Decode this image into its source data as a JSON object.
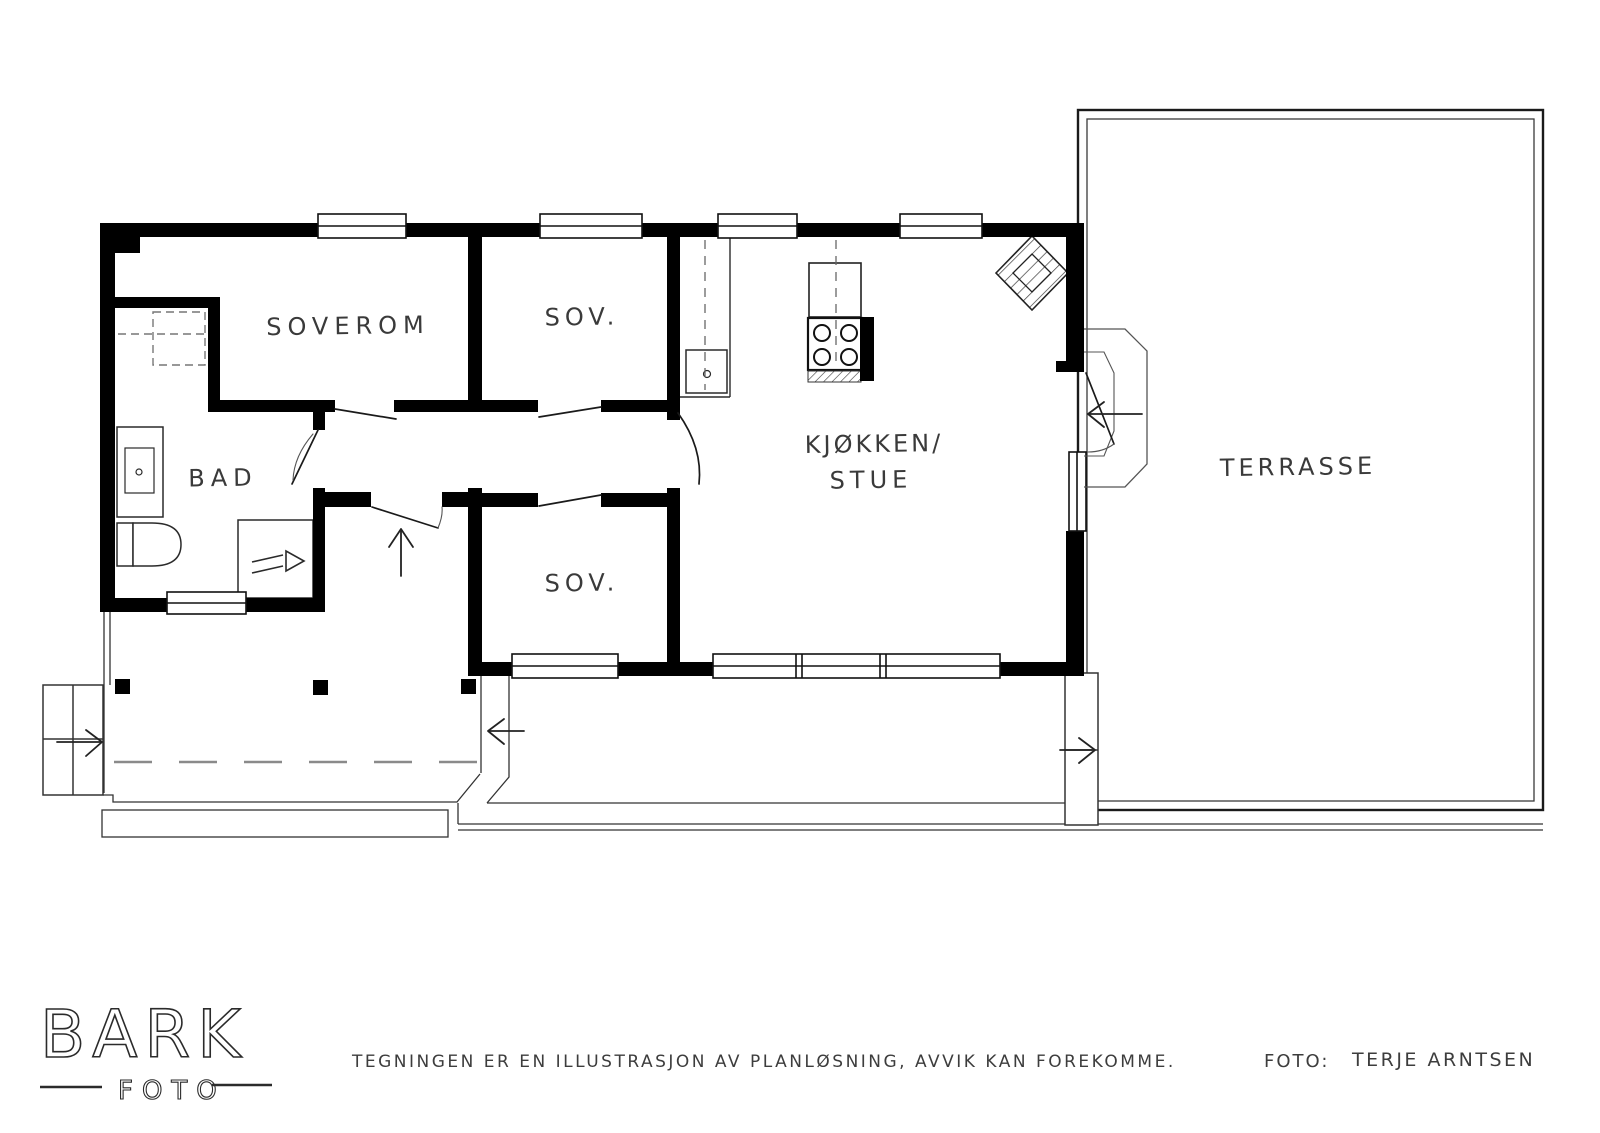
{
  "logo": {
    "brand": "BARK",
    "sub": "FOTO"
  },
  "rooms": {
    "soverom": {
      "label": "SOVEROM"
    },
    "sov_top": {
      "label": "SOV."
    },
    "sov_bottom": {
      "label": "SOV."
    },
    "bad": {
      "label": "BAD"
    },
    "kjokken_stue": {
      "line1": "KJØKKEN/",
      "line2": "STUE"
    },
    "terrasse": {
      "label": "TERRASSE"
    }
  },
  "footer": {
    "disclaimer": "TEGNINGEN ER EN ILLUSTRASJON AV PLANLØSNING, AVVIK KAN FOREKOMME.",
    "credit_label": "FOTO:",
    "credit_name": "TERJE ARNTSEN"
  },
  "symbols": {
    "stove": "4-burner cooktop",
    "sink": "kitchen sink",
    "vanity": "bathroom sink",
    "toilet": "toilet",
    "shower": "shower cabinet",
    "fireplace": "corner fireplace (hatched)",
    "wardrobe": "wardrobe (dashed)",
    "stairs_left": "entry steps with arrow",
    "stairs_right": "terrace steps with arrow",
    "entry_arrow": "entrance direction arrow"
  },
  "colors": {
    "wall": "#000000",
    "thin_line": "#333333",
    "text": "#3a3a3a",
    "background": "#ffffff"
  }
}
